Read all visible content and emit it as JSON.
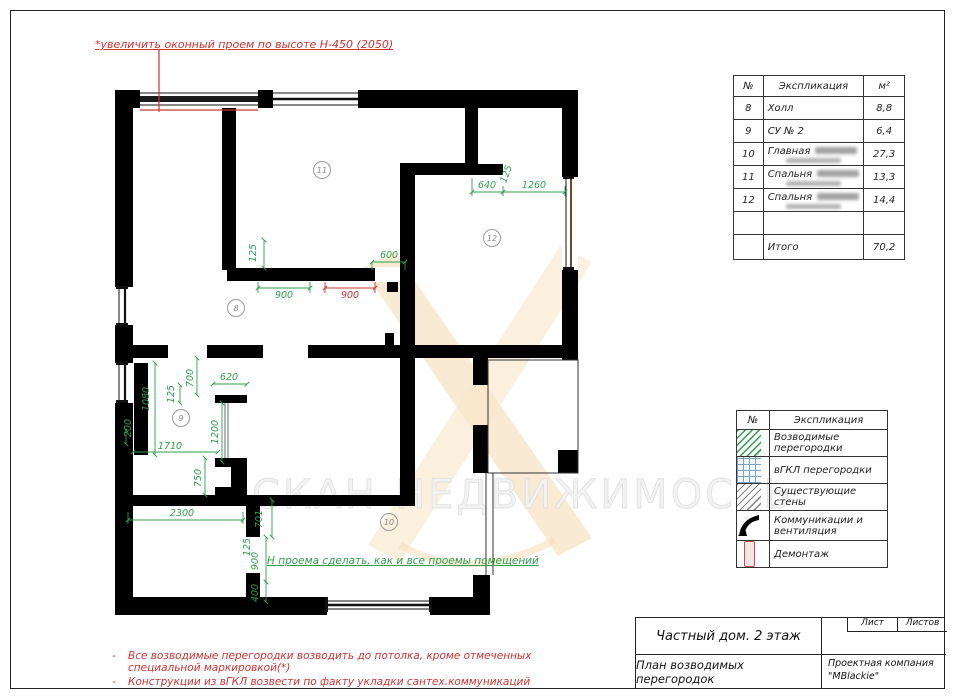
{
  "page": {
    "top_note": "*увеличить оконный проем по высоте Н-450 (2050)",
    "watermark": "СКАН-НЕДВИЖИМОСТЬ",
    "bottom_notes": {
      "bullet": "-",
      "items": [
        "Все возводимые перегородки возводить до потолка, кроме отмеченных специальной маркировкой(*)",
        "Конструкции из вГКЛ возвести по факту укладки сантех.коммуникаций"
      ]
    }
  },
  "plan": {
    "inline_note": "Н проема сделать, как и все проемы помещений",
    "rooms": [
      "11",
      "12",
      "8",
      "9",
      "10"
    ],
    "dims": [
      "125",
      "900",
      "900",
      "600",
      "640",
      "125",
      "1260",
      "1080",
      "200",
      "125",
      "700",
      "620",
      "1200",
      "1710",
      "750",
      "2300",
      "701",
      "125",
      "900",
      "400"
    ]
  },
  "exp_table": {
    "headers": {
      "num": "№",
      "name": "Экспликация",
      "area": "м²"
    },
    "rows": [
      {
        "num": "8",
        "name": "Холл",
        "area": "8,8"
      },
      {
        "num": "9",
        "name": "СУ № 2",
        "area": "6,4"
      },
      {
        "num": "10",
        "name": "Главная",
        "area": "27,3"
      },
      {
        "num": "11",
        "name": "Спальня",
        "area": "13,3"
      },
      {
        "num": "12",
        "name": "Спальня",
        "area": "14,4"
      },
      {
        "num": "",
        "name": "",
        "area": ""
      }
    ],
    "total_label": "Итого",
    "total_value": "70,2"
  },
  "legend": {
    "headers": {
      "num": "№",
      "name": "Экспликация"
    },
    "items": [
      {
        "label": "Возводимые перегородки",
        "swatch": "green-hatch"
      },
      {
        "label": "вГКЛ перегородки",
        "swatch": "blue-grid"
      },
      {
        "label": "Существующие стены",
        "swatch": "gray-hatch"
      },
      {
        "label": "Коммуникации и вентиляция",
        "swatch": "black-solid"
      },
      {
        "label": "Демонтаж",
        "swatch": "red-outline"
      }
    ]
  },
  "title_block": {
    "object": "Частный дом. 2 этаж",
    "drawing": "План возводимых перегородок",
    "sheet_label": "Лист",
    "sheets_label": "Листов",
    "company_line1": "Проектная компания",
    "company_line2": "\"MBlackie\""
  },
  "colors": {
    "new_partition_green": "#2f9e4e",
    "demolition_red": "#c93030",
    "gkl_blue": "#7da3c4",
    "note_red": "#cc3333",
    "logo_orange": "#f5dcb6"
  }
}
